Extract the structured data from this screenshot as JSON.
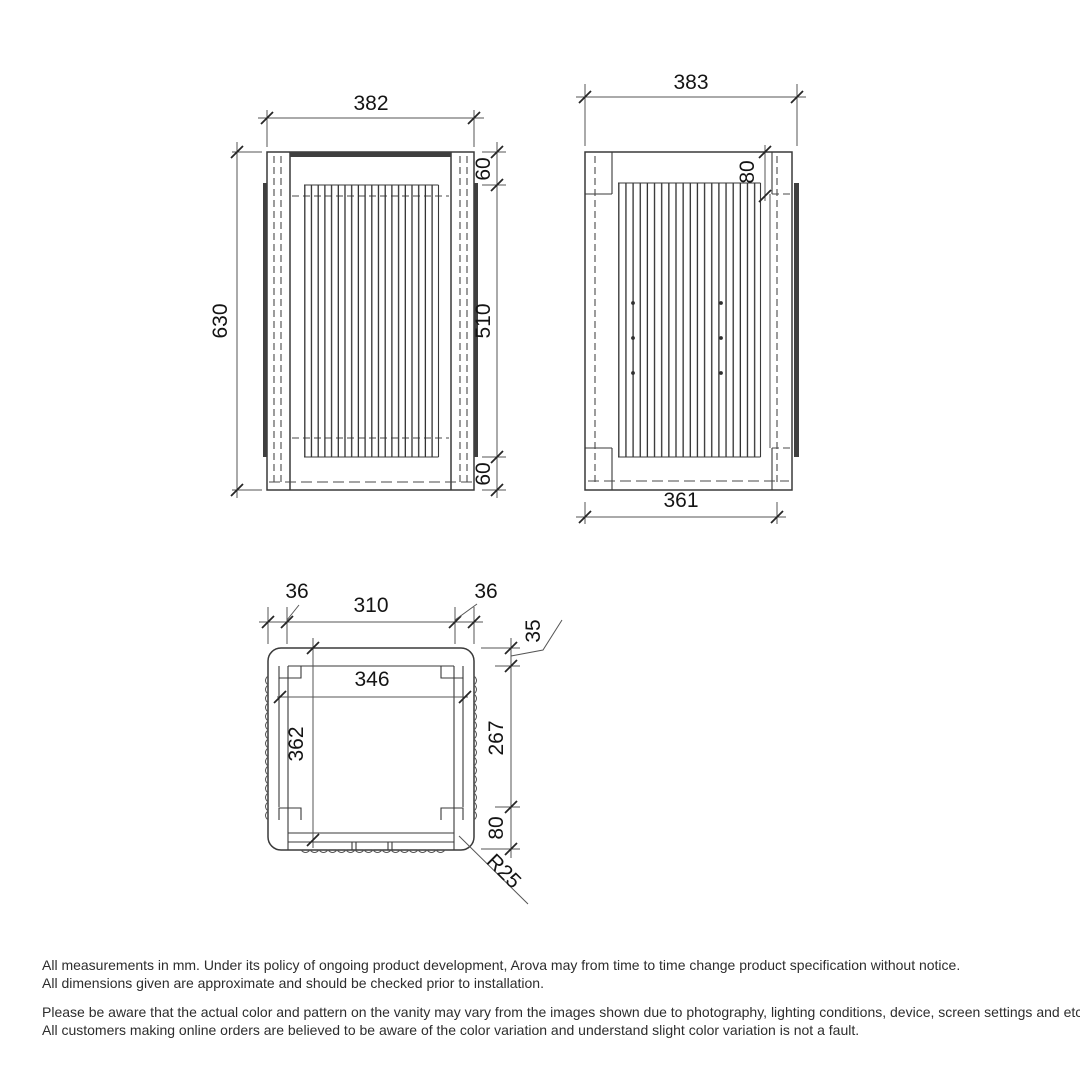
{
  "drawing": {
    "front": {
      "overall_width": "382",
      "overall_height": "630",
      "top_inset": "60",
      "fluted_panel_height": "510",
      "bottom_inset": "60"
    },
    "side": {
      "overall_depth": "383",
      "top_inset": "80",
      "body_depth": "361"
    },
    "plan": {
      "left_edge": "36",
      "opening_width": "310",
      "right_edge": "36",
      "top_wall_thickness": "35",
      "inner_width": "346",
      "depth_to_front": "362",
      "fluted_depth": "267",
      "front_zone": "80",
      "corner_radius": "R25"
    }
  },
  "footer": {
    "line1": "All measurements in mm. Under its policy of ongoing product development, Arova may from time to time change product specification without notice.",
    "line2": "All dimensions given are approximate and should be checked prior to installation.",
    "line3": "Please be aware that the actual color and pattern on the vanity may vary from the images shown due to photography, lighting conditions, device, screen settings and etc.",
    "line4": "All customers making online orders are believed to be aware of the color variation and understand slight color variation is not a fault."
  },
  "colors": {
    "background": "#ffffff",
    "line": "#3a3a3a",
    "text": "#141414"
  }
}
